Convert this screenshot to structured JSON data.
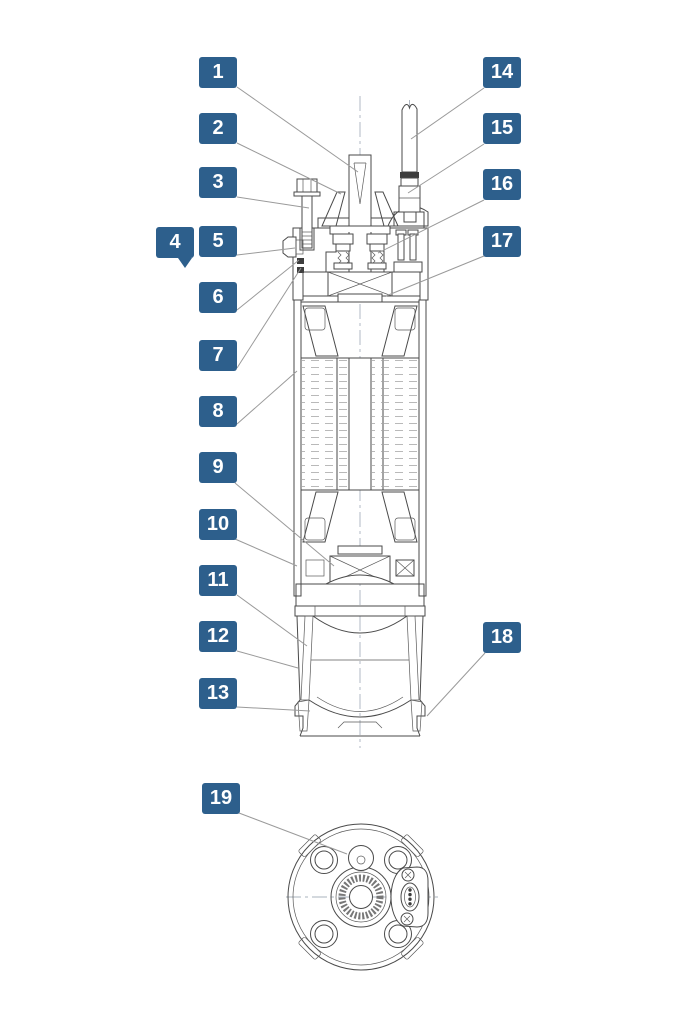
{
  "figure": {
    "kind": "exploded-parts-diagram",
    "subject": "submersible pump cross-section with numbered part callouts",
    "views": {
      "main": "front cross-section view",
      "secondary": "bottom end view"
    }
  },
  "colors": {
    "background": "#ffffff",
    "callout_bg": "#2d5f8c",
    "callout_text": "#ffffff",
    "leader_line": "#9a9a9a",
    "drawing_line": "#4a4a4a"
  },
  "callout_box": {
    "width": 38,
    "height": 31
  },
  "callouts": [
    {
      "num": "1",
      "x": 199,
      "y": 57,
      "leader": [
        237,
        87,
        358,
        172
      ]
    },
    {
      "num": "2",
      "x": 199,
      "y": 113,
      "leader": [
        237,
        143,
        341,
        194
      ]
    },
    {
      "num": "3",
      "x": 199,
      "y": 167,
      "leader": [
        237,
        197,
        309,
        208
      ]
    },
    {
      "num": "4",
      "x": 156,
      "y": 227,
      "tail": true
    },
    {
      "num": "5",
      "x": 199,
      "y": 226,
      "leader": [
        237,
        255,
        295,
        248
      ]
    },
    {
      "num": "6",
      "x": 199,
      "y": 282,
      "leader": [
        237,
        310,
        299,
        260
      ]
    },
    {
      "num": "7",
      "x": 199,
      "y": 340,
      "leader": [
        237,
        368,
        301,
        268
      ]
    },
    {
      "num": "8",
      "x": 199,
      "y": 396,
      "leader": [
        237,
        424,
        297,
        371
      ]
    },
    {
      "num": "9",
      "x": 199,
      "y": 452,
      "leader": [
        235,
        483,
        334,
        566
      ]
    },
    {
      "num": "10",
      "x": 199,
      "y": 509,
      "leader": [
        235,
        539,
        297,
        566
      ]
    },
    {
      "num": "11",
      "x": 199,
      "y": 565,
      "leader": [
        237,
        595,
        307,
        646
      ]
    },
    {
      "num": "12",
      "x": 199,
      "y": 621,
      "leader": [
        237,
        651,
        298,
        668
      ]
    },
    {
      "num": "13",
      "x": 199,
      "y": 678,
      "leader": [
        237,
        707,
        310,
        711
      ]
    },
    {
      "num": "14",
      "x": 483,
      "y": 57,
      "leader": [
        484,
        88,
        411,
        139
      ]
    },
    {
      "num": "15",
      "x": 483,
      "y": 113,
      "leader": [
        484,
        144,
        408,
        193
      ]
    },
    {
      "num": "16",
      "x": 483,
      "y": 169,
      "leader": [
        484,
        200,
        378,
        253
      ]
    },
    {
      "num": "17",
      "x": 483,
      "y": 226,
      "leader": [
        484,
        256,
        386,
        296
      ]
    },
    {
      "num": "18",
      "x": 483,
      "y": 622,
      "leader": [
        485,
        653,
        427,
        716
      ]
    },
    {
      "num": "19",
      "x": 202,
      "y": 783,
      "leader": [
        239,
        813,
        347,
        854
      ]
    }
  ]
}
